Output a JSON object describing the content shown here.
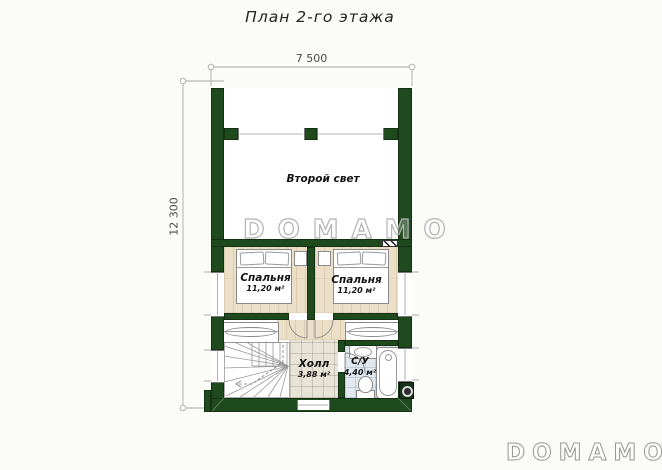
{
  "title": "План 2-го этажа",
  "dimensions": {
    "width_label": "7 500",
    "height_label": "12 300"
  },
  "rooms": {
    "second_light": {
      "name": "Второй свет"
    },
    "bedroom_left": {
      "name": "Спальня",
      "area": "11,20 м²"
    },
    "bedroom_right": {
      "name": "Спальня",
      "area": "11,20 м²"
    },
    "hall": {
      "name": "Холл",
      "area": "3,88 м²"
    },
    "bathroom": {
      "name": "С/У",
      "area": "4,40 м²"
    }
  },
  "branding": {
    "watermark": "DOMAMO",
    "logo": "DOMAMO"
  },
  "colors": {
    "wall_green": "#1f4a1e",
    "wood_floor": "#ecdfc7",
    "hall_tile": "#e8e3d7",
    "bath_tile": "#e0e9f0"
  }
}
